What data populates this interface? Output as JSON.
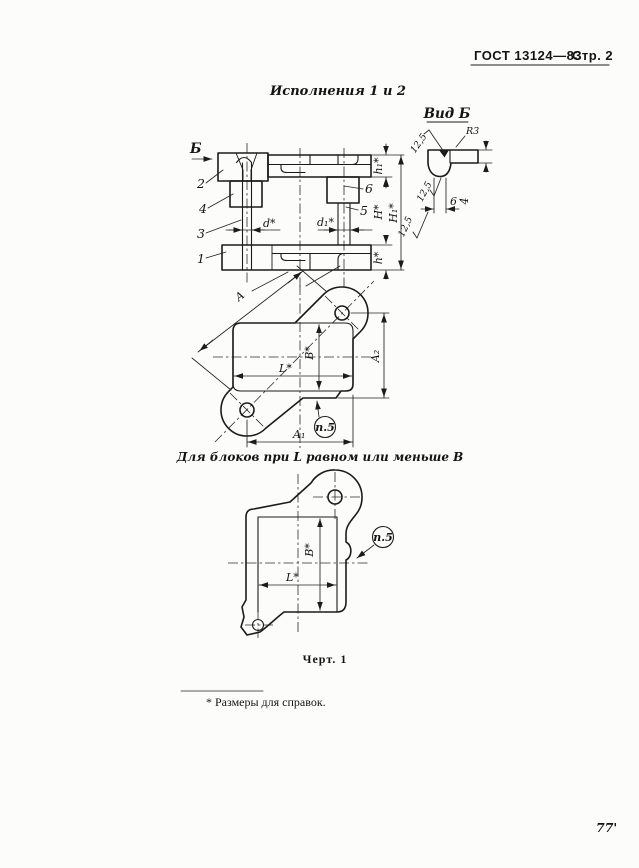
{
  "header": {
    "gost": "ГОСТ 13124—83",
    "page_label": "Стр. 2"
  },
  "titles": {
    "variants": "Исполнения 1 и 2",
    "view_b": "Вид Б",
    "narrow_caption": "Для блоков при L равном или меньше В",
    "figure": "Черт. 1"
  },
  "footnote": "* Размеры для справок.",
  "page_number": "77'",
  "front_view": {
    "view_arrow_label": "Б",
    "item_1": "1",
    "item_2": "2",
    "item_3": "3",
    "item_4": "4",
    "item_5": "5",
    "item_6": "6",
    "dim_d": "d*",
    "dim_d1": "d₁*",
    "dim_h1": "h₁*",
    "dim_H": "H*",
    "dim_H1": "H₁*",
    "dim_h": "h*"
  },
  "view_b": {
    "rough_top": "12,5",
    "radius": "R3",
    "dim_4": "4",
    "rough_mid": "12,5",
    "dim_6": "6",
    "rough_bottom": "12,5"
  },
  "plan_view": {
    "dim_A": "A",
    "dim_B": "B*",
    "dim_L": "L*",
    "dim_A2": "A₂",
    "dim_A1": "A₁",
    "note": "п.5"
  },
  "narrow_view": {
    "dim_B": "B*",
    "dim_L": "L*",
    "note": "п.5"
  }
}
